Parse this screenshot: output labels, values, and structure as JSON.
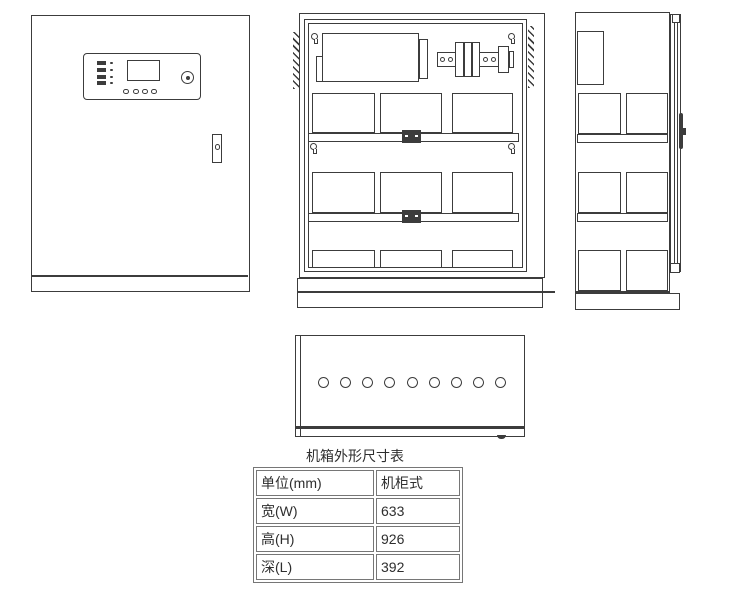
{
  "dimensions_table": {
    "title": "机箱外形尺寸表",
    "rows": [
      {
        "label": "单位(mm)",
        "value": "机柜式"
      },
      {
        "label": "宽(W)",
        "value": "633"
      },
      {
        "label": "高(H)",
        "value": "926"
      },
      {
        "label": "深(L)",
        "value": "392"
      }
    ]
  },
  "colors": {
    "line": "#3c3c3c",
    "text": "#2e2e2e",
    "background": "#ffffff"
  }
}
